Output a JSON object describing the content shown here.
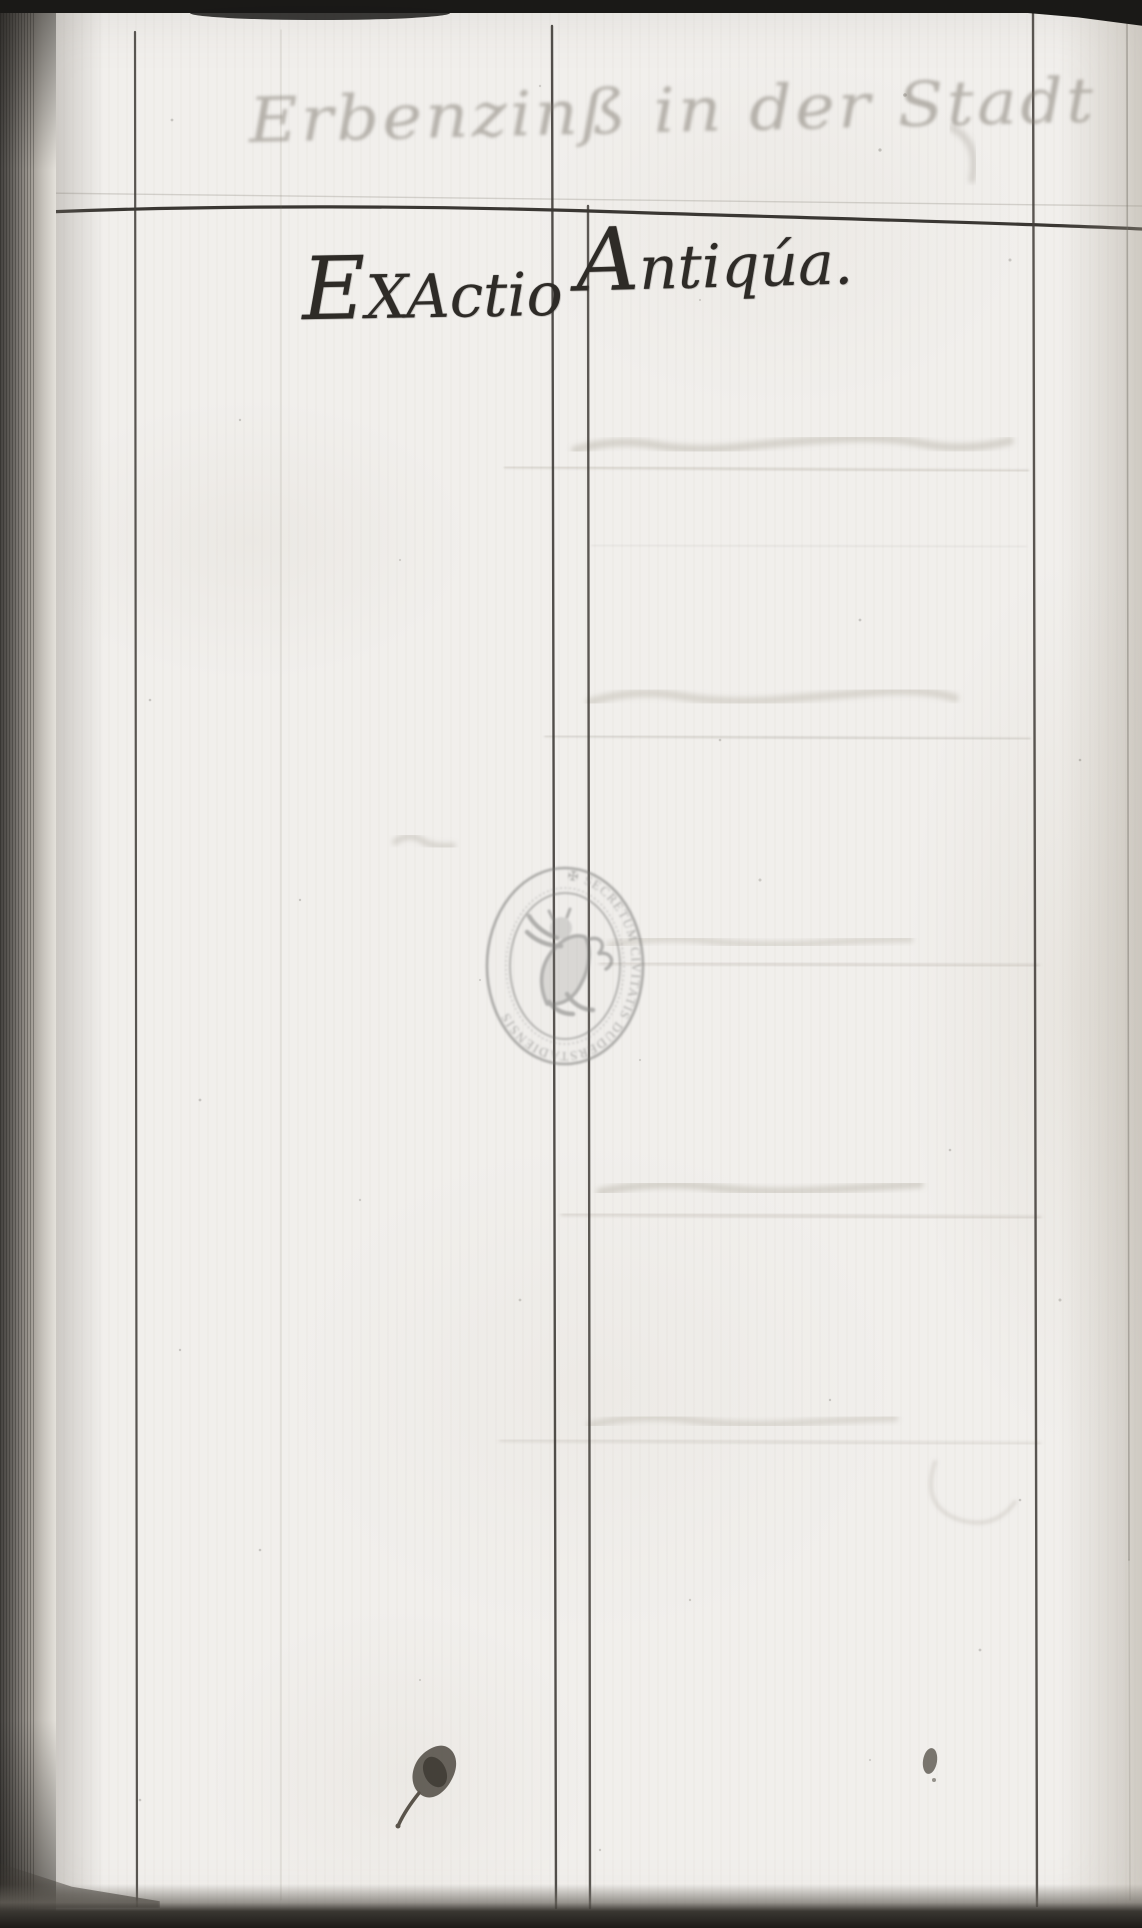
{
  "document": {
    "faded_header": "Erbenzinß in der Stadt",
    "left_column_title": "EXActio",
    "right_column_title": "Antiqúa.",
    "stamp": {
      "legend": "✠ SECRETUM CIVITATIS DUDERSTADIENSIS",
      "symbol": "rampant-lion",
      "ink_color": "#7b7b79"
    },
    "ink_color": "#2e2b27",
    "paper_color": "#f1efec"
  }
}
